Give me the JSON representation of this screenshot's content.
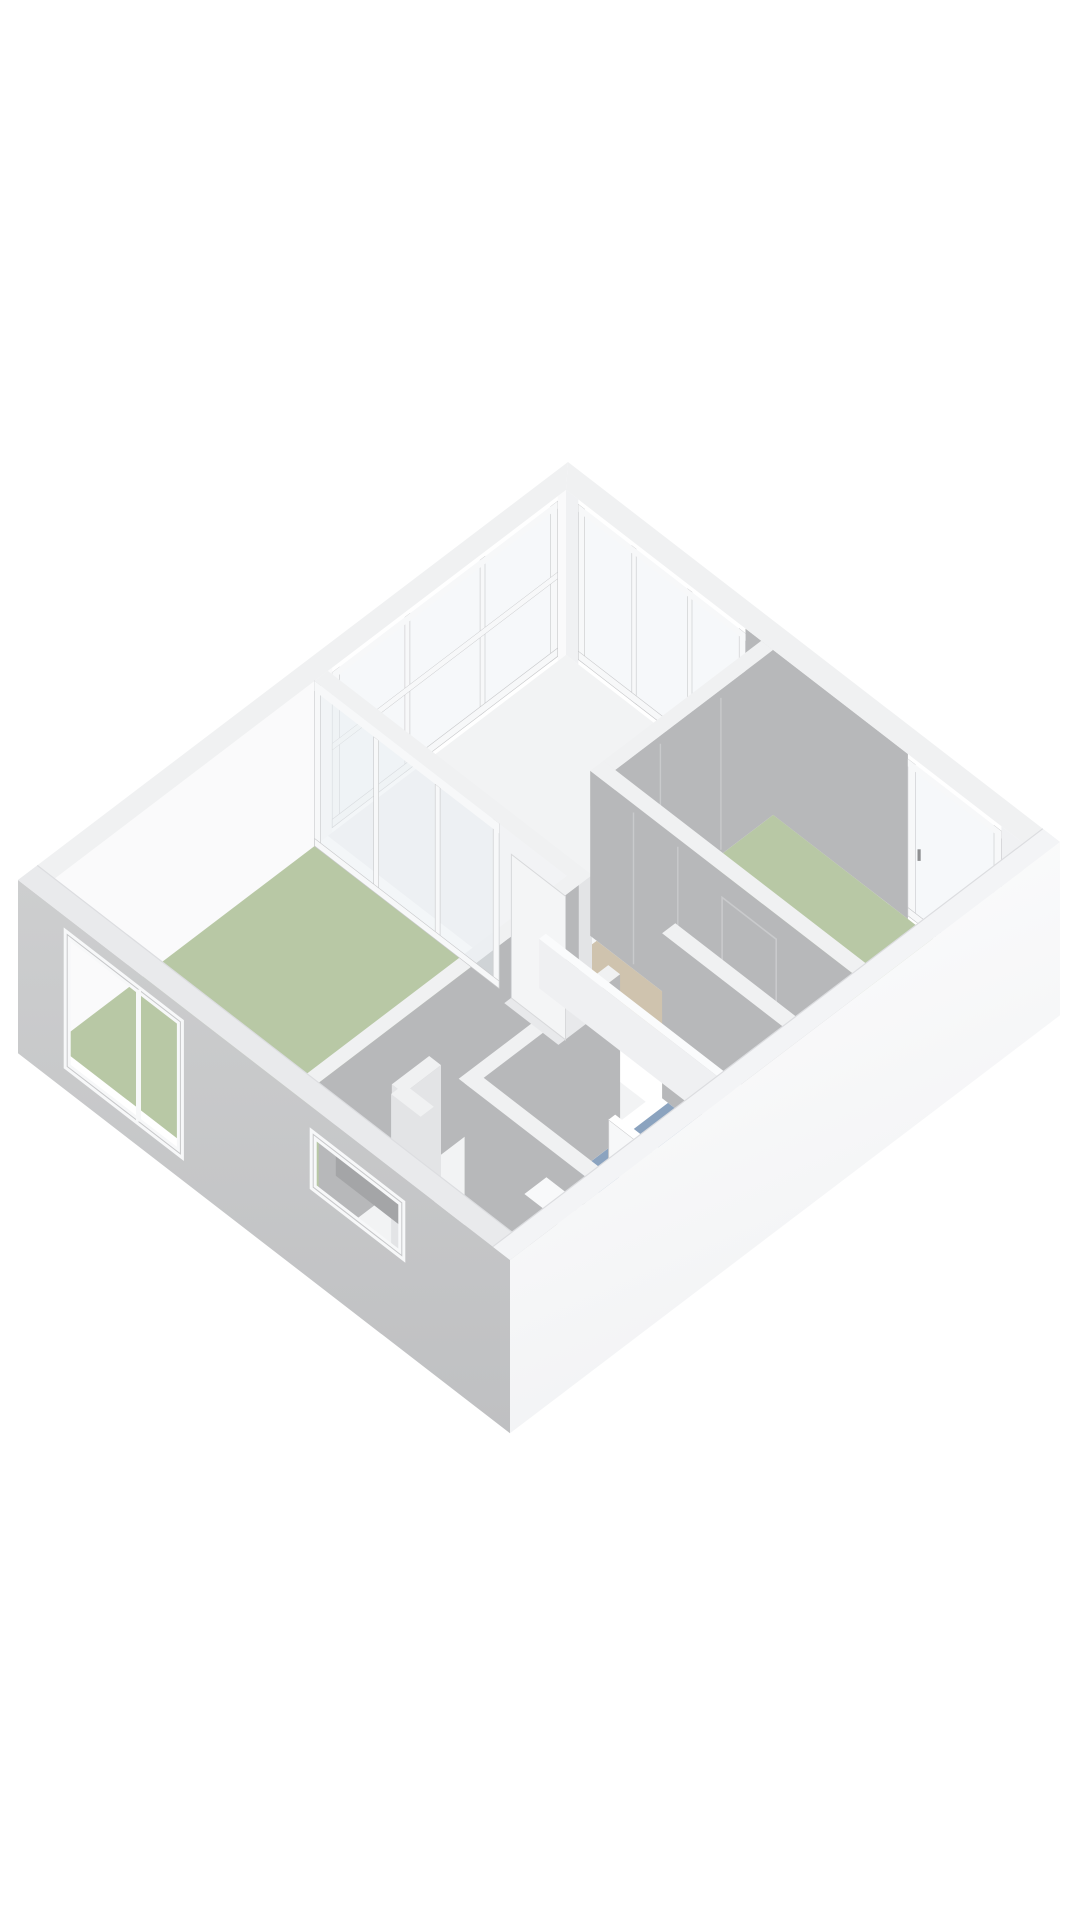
{
  "view": {
    "type": "floorplan-3d-render",
    "background": "#ffffff"
  },
  "colors": {
    "floor_green": "#b8c8a5",
    "floor_green_deep": "#afc19b",
    "floor_blue": "#8ba3bf",
    "floor_tan": "#cfc3ae",
    "floor_white": "#f2f3f4",
    "wall_white": "#fafafb",
    "wall_light": "#f0f1f3",
    "wall_light2": "#f2f3f5",
    "wall_gray": "#b7b8ba",
    "wall_gray_dark": "#a9aaac",
    "exterior_gray_top": "#cdcecf",
    "exterior_gray_bottom": "#bfc0c2",
    "exterior_white_top": "#fefefe",
    "exterior_white_bottom": "#f1f2f4",
    "top_band": "#f0f1f2",
    "top_band_near": "#e9eaec",
    "edge": "#dcdde0",
    "frame_white": "#f7f8f9",
    "frame_line": "#c7c8ca",
    "glass": "#f6f8fa",
    "glass_dark": "#a4a5a7",
    "glass_partition": "#e8eef2",
    "door_white": "#f4f5f6",
    "handle_gray": "#8f9092",
    "seam": "#c9cacc",
    "cap": "#e3e4e6",
    "toilet_white": "#f7f8f9",
    "toilet_line": "#dddedf",
    "threshold": "#e8e9eb",
    "nosing": "#f5f6f7",
    "rail_face": "#eff0f2",
    "rail_top": "#fafbfc",
    "backdrop_dark": "#a4a5a7"
  },
  "projection": {
    "origin": [
      18,
      1045
    ],
    "axisA": [
      550,
      -418
    ],
    "axisB": [
      492,
      380
    ],
    "wallHeight": 165,
    "slab": 0.05
  },
  "floorplan": {
    "rooms": [
      {
        "id": "bedroom-left-floor",
        "color": "floor_green",
        "rect": [
          0.035,
          0.035,
          0.508,
          0.548
        ]
      },
      {
        "id": "landing-floor",
        "color": "floor_white",
        "rect": [
          0.532,
          0.035,
          0.965,
          0.432
        ]
      },
      {
        "id": "corridor-floor-a",
        "color": "floor_white",
        "rect": [
          0.035,
          0.572,
          0.508,
          0.708
        ]
      },
      {
        "id": "corridor-floor-b",
        "color": "floor_white",
        "rect": [
          0.035,
          0.708,
          0.168,
          0.965
        ]
      },
      {
        "id": "stair-void-floor",
        "color": "floor_tan",
        "rect": [
          0.557,
          0.445,
          0.654,
          0.9
        ]
      },
      {
        "id": "stair-end-floor",
        "color": "floor_white",
        "rect": [
          0.557,
          0.9,
          0.654,
          0.965
        ]
      },
      {
        "id": "bedroom-right-floor",
        "color": "floor_green",
        "rect": [
          0.684,
          0.456,
          0.965,
          0.965
        ]
      },
      {
        "id": "bathroom-floor",
        "color": "floor_blue",
        "rect": [
          0.192,
          0.732,
          0.527,
          0.965
        ]
      }
    ],
    "stair_nosing": {
      "a": [
        0.557,
        0.654
      ],
      "b": [
        0.425,
        0.445
      ]
    },
    "exterior": {
      "nw_wall": {
        "face_sections": [
          {
            "t": [
              0.035,
              0.54
            ],
            "color": "wall_white"
          },
          {
            "t": [
              0.95,
              0.965
            ],
            "color": "wall_white"
          }
        ],
        "glazing": {
          "range": [
            0.54,
            0.95
          ],
          "panes": 3,
          "z": [
            0.03,
            0.97
          ],
          "mid_rail": 0.52
        }
      },
      "ne_wall": {
        "face_sections": [
          {
            "t": [
              0.035,
              0.06
            ],
            "color": "wall_light"
          },
          {
            "t": [
              0.4,
              0.73
            ],
            "color": "wall_gray"
          },
          {
            "t": [
              0.92,
              0.965
            ],
            "color": "wall_light"
          }
        ],
        "glazing": {
          "range": [
            0.06,
            0.4
          ],
          "panes": 3,
          "z": [
            0.03,
            0.97
          ]
        },
        "french_window": {
          "range": [
            0.73,
            0.92
          ],
          "z": [
            0.02,
            0.97
          ],
          "handle": {
            "b": 0.755,
            "z": 0.45
          }
        }
      },
      "sw_wall": {
        "windows": [
          {
            "id": "bedroom-window",
            "b": [
              0.1,
              0.33
            ],
            "z": [
              0.1,
              0.9
            ],
            "mullion": 0.245,
            "backdrop": "room"
          },
          {
            "id": "bathroom-slit-window",
            "b": [
              0.6,
              0.78
            ],
            "z": [
              0.52,
              0.84
            ],
            "backdrop": "dark"
          }
        ]
      },
      "se_wall": {}
    },
    "interior_walls": [
      {
        "id": "landing-right-wall",
        "axis": "b",
        "pos": 0.444,
        "span": [
          0.678,
          0.965
        ],
        "t": 0.024,
        "face": "wall_gray",
        "cap": true,
        "seams": [
          0.76,
          0.87
        ]
      },
      {
        "id": "bedroom-left-door-wall",
        "axis": "a",
        "pos": 0.52,
        "span": [
          0.41,
          0.572
        ],
        "t": 0.024,
        "face": "wall_light2",
        "cap": true
      },
      {
        "id": "stair-closet-wall",
        "axis": "a",
        "pos": 0.666,
        "span": [
          0.432,
          0.965
        ],
        "t": 0.024,
        "face": "wall_gray",
        "cap": false,
        "seams": [
          0.52,
          0.61
        ],
        "door_outline": [
          0.7,
          0.81
        ]
      },
      {
        "id": "bedroom-left-south-wall",
        "axis": "b",
        "pos": 0.56,
        "span": [
          0.035,
          0.508
        ],
        "t": 0.024,
        "face": "wall_gray",
        "cap": false
      },
      {
        "id": "bathroom-east-wall",
        "axis": "a",
        "pos": 0.539,
        "span": [
          0.72,
          0.965
        ],
        "t": 0.024,
        "face": "wall_gray",
        "cap": false
      },
      {
        "id": "bathroom-north-wall",
        "axis": "b",
        "pos": 0.72,
        "span": [
          0.168,
          0.44
        ],
        "t": 0.024,
        "face": "wall_gray",
        "cap": false
      },
      {
        "id": "duct-wall-a",
        "axis": "b",
        "pos": 0.66,
        "span": [
          0.1,
          0.168
        ],
        "t": 0.024,
        "face": "cap",
        "cap": true
      },
      {
        "id": "duct-wall-b",
        "axis": "a",
        "pos": 0.1,
        "span": [
          0.66,
          0.72
        ],
        "t": 0.024,
        "face": "cap",
        "cap": true
      },
      {
        "id": "bathroom-west-wall",
        "axis": "a",
        "pos": 0.18,
        "span": [
          0.72,
          0.965
        ],
        "t": 0.024,
        "face": "wall_gray",
        "cap": true
      }
    ],
    "glass_partition": {
      "id": "bedroom-left-glass-partition",
      "a": 0.52,
      "b": [
        0.035,
        0.41
      ],
      "mullions": [
        0.16,
        0.285
      ]
    },
    "door": {
      "id": "bedroom-left-door",
      "a": 0.508,
      "b": [
        0.435,
        0.545
      ],
      "height": 0.87,
      "handle": {
        "b": 0.53,
        "z": 0.45
      }
    },
    "fixtures": {
      "toilet": {
        "bowl": [
          0.275,
          0.8375
        ],
        "tank": [
          0.205,
          0.8,
          0.245,
          0.875
        ],
        "tank_h": 0.42
      },
      "shower_screen": {
        "a": 0.4,
        "b": [
          0.76,
          0.9
        ],
        "h": 0.3
      },
      "railing": {
        "long": {
          "a": 0.551,
          "b": [
            0.45,
            0.86
          ]
        },
        "return": {
          "b": 0.86,
          "a": [
            0.551,
            0.6
          ]
        },
        "t": 0.012,
        "h": 0.3
      }
    }
  }
}
